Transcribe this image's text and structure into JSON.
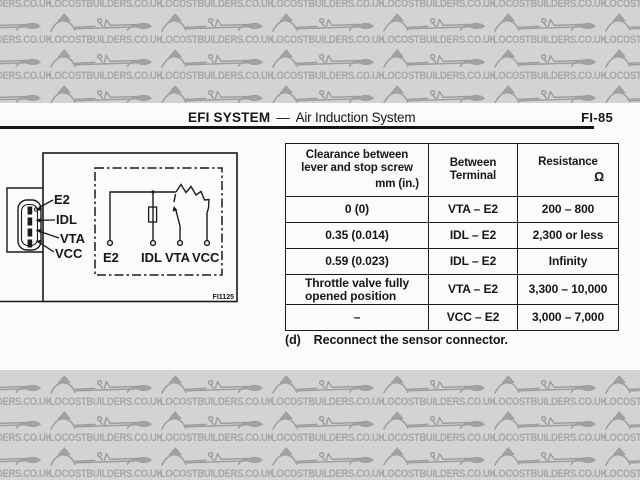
{
  "watermark": {
    "text": "LOCOSTBUILDERS.CO.UK"
  },
  "header": {
    "section": "EFI SYSTEM",
    "separator": "—",
    "subsection": "Air Induction System",
    "page_code": "FI-85"
  },
  "figure": {
    "code": "FI1125",
    "connector_labels": {
      "e2": "E2",
      "idl": "IDL",
      "vta": "VTA",
      "vcc": "VCC"
    },
    "terminal_labels": {
      "e2": "E2",
      "idl": "IDL",
      "vta": "VTA",
      "vcc": "VCC"
    }
  },
  "table": {
    "header": {
      "col1_line1": "Clearance between",
      "col1_line2": "lever and stop screw",
      "col1_unit": "mm (in.)",
      "col2_line1": "Between",
      "col2_line2": "Terminal",
      "col3_line1": "Resistance",
      "col3_unit": "Ω"
    },
    "rows": [
      {
        "clearance": "0 (0)",
        "terminal": "VTA – E2",
        "resistance": "200 – 800"
      },
      {
        "clearance": "0.35 (0.014)",
        "terminal": "IDL – E2",
        "resistance": "2,300 or less"
      },
      {
        "clearance": "0.59 (0.023)",
        "terminal": "IDL – E2",
        "resistance": "Infinity"
      },
      {
        "clearance": "Throttle valve fully opened position",
        "terminal": "VTA – E2",
        "resistance": "3,300 – 10,000"
      },
      {
        "clearance": "–",
        "terminal": "VCC – E2",
        "resistance": "3,000 – 7,000"
      }
    ]
  },
  "note": {
    "label": "(d)",
    "text": "Reconnect the sensor connector."
  }
}
